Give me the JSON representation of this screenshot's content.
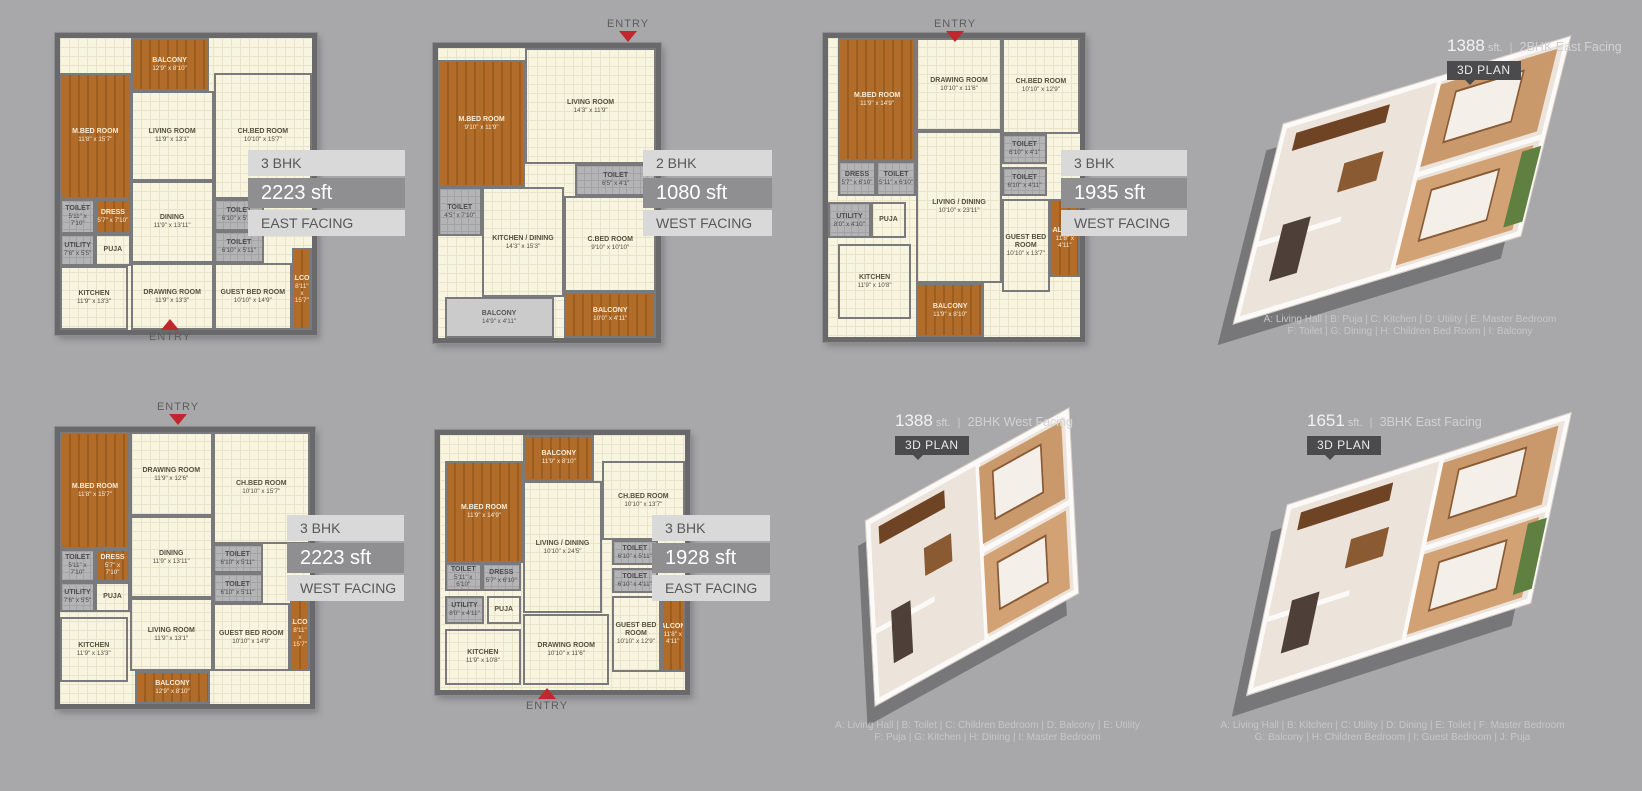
{
  "page": {
    "background": "#a8a8aa",
    "accent_red": "#c1272d",
    "badge_bg": "#4b4b4d",
    "band_dark": "#8f8f92",
    "band_light": "#d9d9d9"
  },
  "plans2d": [
    {
      "name": "3bhk-2223-east",
      "entry_label": "ENTRY",
      "band": {
        "bhk": "3 BHK",
        "area": "2223 sft",
        "facing": "EAST FACING"
      },
      "rooms": [
        {
          "label": "BALCONY",
          "dims": "12'9\" x 8'10\"",
          "type": "wood",
          "x": 28,
          "y": 0,
          "w": 31,
          "h": 18
        },
        {
          "label": "M.BED ROOM",
          "dims": "11'8\" x 15'7\"",
          "type": "wood",
          "x": 0,
          "y": 12,
          "w": 28,
          "h": 43
        },
        {
          "label": "LIVING ROOM",
          "dims": "11'9\" x 13'1\"",
          "type": "cream",
          "x": 28,
          "y": 18,
          "w": 33,
          "h": 31
        },
        {
          "label": "CH.BED ROOM",
          "dims": "10'10\" x 15'7\"",
          "type": "cream",
          "x": 61,
          "y": 12,
          "w": 39,
          "h": 43
        },
        {
          "label": "DINING",
          "dims": "11'9\" x 13'11\"",
          "type": "cream",
          "x": 28,
          "y": 49,
          "w": 33,
          "h": 28
        },
        {
          "label": "TOILET",
          "dims": "5'11\" x 7'10\"",
          "type": "toilet",
          "x": 0,
          "y": 55,
          "w": 14,
          "h": 12
        },
        {
          "label": "DRESS",
          "dims": "5'7\" x 7'10\"",
          "type": "wood",
          "x": 14,
          "y": 55,
          "w": 14,
          "h": 12
        },
        {
          "label": "UTILITY",
          "dims": "7'6\" x 5'5\"",
          "type": "toilet",
          "x": 0,
          "y": 67,
          "w": 14,
          "h": 11
        },
        {
          "label": "PUJA",
          "dims": "",
          "type": "cream",
          "x": 14,
          "y": 67,
          "w": 14,
          "h": 11
        },
        {
          "label": "TOILET",
          "dims": "6'10\" x 5'11\"",
          "type": "toilet",
          "x": 61,
          "y": 55,
          "w": 20,
          "h": 11
        },
        {
          "label": "TOILET",
          "dims": "6'10\" x 5'11\"",
          "type": "toilet",
          "x": 61,
          "y": 66,
          "w": 20,
          "h": 11
        },
        {
          "label": "DRAWING ROOM",
          "dims": "11'9\" x 13'3\"",
          "type": "cream",
          "x": 28,
          "y": 77,
          "w": 33,
          "h": 23
        },
        {
          "label": "GUEST BED ROOM",
          "dims": "10'10\" x 14'9\"",
          "type": "cream",
          "x": 61,
          "y": 77,
          "w": 31,
          "h": 23
        },
        {
          "label": "KITCHEN",
          "dims": "11'9\" x 13'3\"",
          "type": "cream",
          "x": 0,
          "y": 78,
          "w": 27,
          "h": 22
        },
        {
          "label": "BALCONY",
          "dims": "8'11\" x 15'7\"",
          "type": "wood",
          "x": 92,
          "y": 72,
          "w": 8,
          "h": 28
        }
      ]
    },
    {
      "name": "2bhk-1080-west",
      "entry_label": "ENTRY",
      "band": {
        "bhk": "2 BHK",
        "area": "1080 sft",
        "facing": "WEST FACING"
      },
      "rooms": [
        {
          "label": "LIVING ROOM",
          "dims": "14'3\" x 11'9\"",
          "type": "cream",
          "x": 40,
          "y": 0,
          "w": 60,
          "h": 40
        },
        {
          "label": "M.BED ROOM",
          "dims": "9'10\" x 11'9\"",
          "type": "wood",
          "x": 0,
          "y": 4,
          "w": 40,
          "h": 44
        },
        {
          "label": "TOILET",
          "dims": "4'5\" x 7'10\"",
          "type": "toilet",
          "x": 0,
          "y": 48,
          "w": 20,
          "h": 17
        },
        {
          "label": "TOILET",
          "dims": "6'5\" x 4'1\"",
          "type": "toilet",
          "x": 63,
          "y": 40,
          "w": 37,
          "h": 11
        },
        {
          "label": "C.BED ROOM",
          "dims": "9'10\" x 10'10\"",
          "type": "cream",
          "x": 58,
          "y": 51,
          "w": 42,
          "h": 33
        },
        {
          "label": "KITCHEN / DINING",
          "dims": "14'3\" x 15'3\"",
          "type": "cream",
          "x": 20,
          "y": 48,
          "w": 38,
          "h": 38
        },
        {
          "label": "BALCONY",
          "dims": "14'9\" x 4'11\"",
          "type": "gray",
          "x": 3,
          "y": 86,
          "w": 50,
          "h": 14
        },
        {
          "label": "BALCONY",
          "dims": "10'0\" x 4'11\"",
          "type": "wood",
          "x": 58,
          "y": 84,
          "w": 42,
          "h": 16
        }
      ]
    },
    {
      "name": "3bhk-1935-west",
      "entry_label": "ENTRY",
      "band": {
        "bhk": "3 BHK",
        "area": "1935 sft",
        "facing": "WEST FACING"
      },
      "rooms": [
        {
          "label": "M.BED ROOM",
          "dims": "11'9\" x 14'9\"",
          "type": "wood",
          "x": 4,
          "y": 0,
          "w": 31,
          "h": 41
        },
        {
          "label": "DRAWING ROOM",
          "dims": "10'10\" x 11'6\"",
          "type": "cream",
          "x": 35,
          "y": 0,
          "w": 34,
          "h": 31
        },
        {
          "label": "CH.BED ROOM",
          "dims": "10'10\" x 12'9\"",
          "type": "cream",
          "x": 69,
          "y": 0,
          "w": 31,
          "h": 32
        },
        {
          "label": "DRESS",
          "dims": "5'7\" x 6'10\"",
          "type": "toilet",
          "x": 4,
          "y": 41,
          "w": 15,
          "h": 12
        },
        {
          "label": "TOILET",
          "dims": "5'11\" x 6'10\"",
          "type": "toilet",
          "x": 19,
          "y": 41,
          "w": 16,
          "h": 12
        },
        {
          "label": "TOILET",
          "dims": "6'10\" x 4'1\"",
          "type": "toilet",
          "x": 69,
          "y": 32,
          "w": 18,
          "h": 10
        },
        {
          "label": "TOILET",
          "dims": "6'10\" x 4'11\"",
          "type": "toilet",
          "x": 69,
          "y": 43,
          "w": 18,
          "h": 10
        },
        {
          "label": "UTILITY",
          "dims": "8'0\" x 4'10\"",
          "type": "toilet",
          "x": 0,
          "y": 55,
          "w": 17,
          "h": 12
        },
        {
          "label": "PUJA",
          "dims": "",
          "type": "cream",
          "x": 17,
          "y": 55,
          "w": 14,
          "h": 12
        },
        {
          "label": "LIVING / DINING",
          "dims": "10'10\" x 23'11\"",
          "type": "cream",
          "x": 35,
          "y": 31,
          "w": 34,
          "h": 51
        },
        {
          "label": "KITCHEN",
          "dims": "11'9\" x 10'8\"",
          "type": "cream",
          "x": 4,
          "y": 69,
          "w": 29,
          "h": 25
        },
        {
          "label": "GUEST BED ROOM",
          "dims": "10'10\" x 13'7\"",
          "type": "cream",
          "x": 69,
          "y": 54,
          "w": 19,
          "h": 31
        },
        {
          "label": "BALCONY",
          "dims": "11'8\" x 4'11\"",
          "type": "wood",
          "x": 88,
          "y": 54,
          "w": 12,
          "h": 26
        },
        {
          "label": "BALCONY",
          "dims": "11'9\" x 8'10\"",
          "type": "wood",
          "x": 35,
          "y": 82,
          "w": 27,
          "h": 18
        }
      ]
    },
    {
      "name": "3bhk-2223-west",
      "entry_label": "ENTRY",
      "band": {
        "bhk": "3 BHK",
        "area": "2223 sft",
        "facing": "WEST FACING"
      },
      "rooms": [
        {
          "label": "M.BED ROOM",
          "dims": "11'8\" x 15'7\"",
          "type": "wood",
          "x": 0,
          "y": 0,
          "w": 28,
          "h": 43
        },
        {
          "label": "DRAWING ROOM",
          "dims": "11'9\" x 12'6\"",
          "type": "cream",
          "x": 28,
          "y": 0,
          "w": 33,
          "h": 31
        },
        {
          "label": "CH.BED ROOM",
          "dims": "10'10\" x 15'7\"",
          "type": "cream",
          "x": 61,
          "y": 0,
          "w": 39,
          "h": 41
        },
        {
          "label": "TOILET",
          "dims": "5'11\" x 7'10\"",
          "type": "toilet",
          "x": 0,
          "y": 43,
          "w": 14,
          "h": 12
        },
        {
          "label": "DRESS",
          "dims": "5'7\" x 7'10\"",
          "type": "wood",
          "x": 14,
          "y": 43,
          "w": 14,
          "h": 12
        },
        {
          "label": "UTILITY",
          "dims": "7'6\" x 5'5\"",
          "type": "toilet",
          "x": 0,
          "y": 55,
          "w": 14,
          "h": 11
        },
        {
          "label": "PUJA",
          "dims": "",
          "type": "cream",
          "x": 14,
          "y": 55,
          "w": 14,
          "h": 11
        },
        {
          "label": "DINING",
          "dims": "11'9\" x 13'11\"",
          "type": "cream",
          "x": 28,
          "y": 31,
          "w": 33,
          "h": 30
        },
        {
          "label": "TOILET",
          "dims": "6'10\" x 5'11\"",
          "type": "toilet",
          "x": 61,
          "y": 41,
          "w": 20,
          "h": 11
        },
        {
          "label": "TOILET",
          "dims": "6'10\" x 5'11\"",
          "type": "toilet",
          "x": 61,
          "y": 52,
          "w": 20,
          "h": 11
        },
        {
          "label": "LIVING ROOM",
          "dims": "11'9\" x 13'1\"",
          "type": "cream",
          "x": 28,
          "y": 61,
          "w": 33,
          "h": 27
        },
        {
          "label": "GUEST BED ROOM",
          "dims": "10'10\" x 14'9\"",
          "type": "cream",
          "x": 61,
          "y": 63,
          "w": 31,
          "h": 25
        },
        {
          "label": "KITCHEN",
          "dims": "11'9\" x 13'3\"",
          "type": "cream",
          "x": 0,
          "y": 68,
          "w": 27,
          "h": 24
        },
        {
          "label": "BALCONY",
          "dims": "12'9\" x 8'10\"",
          "type": "wood",
          "x": 30,
          "y": 88,
          "w": 30,
          "h": 12
        },
        {
          "label": "BALCONY",
          "dims": "8'11\" x 15'7\"",
          "type": "wood",
          "x": 92,
          "y": 60,
          "w": 8,
          "h": 28
        }
      ]
    },
    {
      "name": "3bhk-1928-east",
      "entry_label": "ENTRY",
      "band": {
        "bhk": "3 BHK",
        "area": "1928 sft",
        "facing": "EAST FACING"
      },
      "rooms": [
        {
          "label": "BALCONY",
          "dims": "11'9\" x 8'10\"",
          "type": "wood",
          "x": 34,
          "y": 0,
          "w": 29,
          "h": 18
        },
        {
          "label": "M.BED ROOM",
          "dims": "11'9\" x 14'9\"",
          "type": "wood",
          "x": 2,
          "y": 10,
          "w": 32,
          "h": 40
        },
        {
          "label": "LIVING / DINING",
          "dims": "10'10\" x 24'5\"",
          "type": "cream",
          "x": 34,
          "y": 18,
          "w": 32,
          "h": 52
        },
        {
          "label": "CH.BED ROOM",
          "dims": "10'10\" x 13'7\"",
          "type": "cream",
          "x": 66,
          "y": 10,
          "w": 34,
          "h": 31
        },
        {
          "label": "TOILET",
          "dims": "6'10\" x 5'11\"",
          "type": "toilet",
          "x": 70,
          "y": 41,
          "w": 19,
          "h": 10
        },
        {
          "label": "TOILET",
          "dims": "6'10\" x 4'11\"",
          "type": "toilet",
          "x": 70,
          "y": 52,
          "w": 19,
          "h": 10
        },
        {
          "label": "TOILET",
          "dims": "5'11\" x 6'10\"",
          "type": "toilet",
          "x": 2,
          "y": 50,
          "w": 15,
          "h": 11
        },
        {
          "label": "DRESS",
          "dims": "5'7\" x 6'10\"",
          "type": "toilet",
          "x": 17,
          "y": 50,
          "w": 16,
          "h": 11
        },
        {
          "label": "UTILITY",
          "dims": "8'0\" x 4'11\"",
          "type": "toilet",
          "x": 2,
          "y": 63,
          "w": 16,
          "h": 11
        },
        {
          "label": "PUJA",
          "dims": "",
          "type": "cream",
          "x": 19,
          "y": 63,
          "w": 14,
          "h": 11
        },
        {
          "label": "KITCHEN",
          "dims": "11'9\" x 10'8\"",
          "type": "cream",
          "x": 2,
          "y": 76,
          "w": 31,
          "h": 22
        },
        {
          "label": "DRAWING ROOM",
          "dims": "10'10\" x 11'6\"",
          "type": "cream",
          "x": 34,
          "y": 70,
          "w": 35,
          "h": 28
        },
        {
          "label": "GUEST BED ROOM",
          "dims": "10'10\" x 12'9\"",
          "type": "cream",
          "x": 70,
          "y": 63,
          "w": 20,
          "h": 30
        },
        {
          "label": "BALCONY",
          "dims": "11'8\" x 4'11\"",
          "type": "wood",
          "x": 90,
          "y": 63,
          "w": 10,
          "h": 30
        }
      ]
    }
  ],
  "plans3d": [
    {
      "area": "1388",
      "area_unit": "sft.",
      "separator": "|",
      "desc": "2BHK East Facing",
      "badge": "3D PLAN",
      "legend": [
        "A: Living Hall | B: Puja | C: Kitchen | D: Utility  | E: Master Bedroom",
        "F: Toilet | G: Dining | H: Children Bed Room | I: Balcony"
      ]
    },
    {
      "area": "1388",
      "area_unit": "sft.",
      "separator": "|",
      "desc": "2BHK West Facing",
      "badge": "3D PLAN",
      "legend": [
        "A: Living Hall | B: Toilet | C: Children Bedroom | D: Balcony  | E: Utility",
        "F: Puja  | G: Kitchen  | H: Dining | I: Master Bedroom"
      ]
    },
    {
      "area": "1651",
      "area_unit": "sft.",
      "separator": "|",
      "desc": "3BHK East Facing",
      "badge": "3D PLAN",
      "legend": [
        "A: Living Hall | B: Kitchen | C: Utility | D: Dining  | E: Toilet  |  F: Master Bedroom",
        "G: Balcony  | H: Children Bedroom | I: Guest Bedroom |  J: Puja"
      ]
    }
  ]
}
